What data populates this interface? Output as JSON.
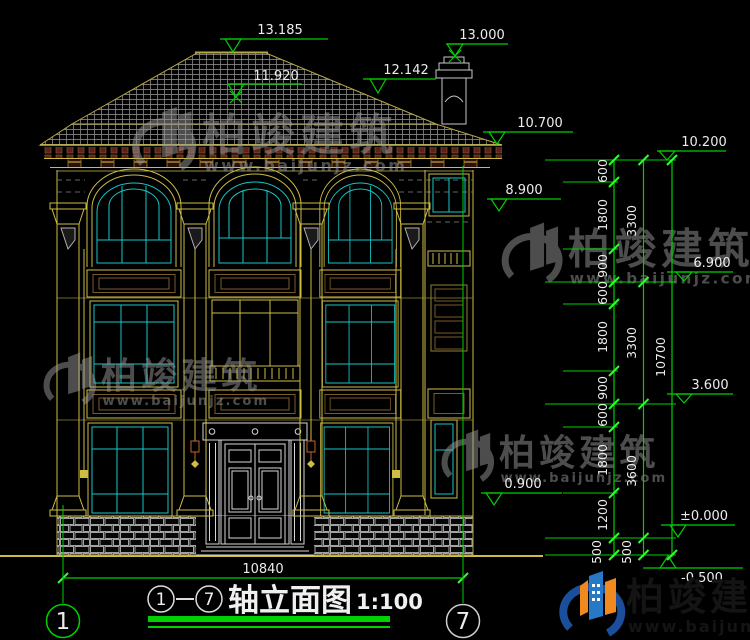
{
  "title": {
    "axis_from": "1",
    "axis_to": "7",
    "name": "轴立面图",
    "scale": "1:100"
  },
  "axis": {
    "left": "1",
    "right": "7"
  },
  "overall_width": "10840",
  "elevations": {
    "ridge": "13.185",
    "chimney": "13.000",
    "roof_step": "12.142",
    "roof_mid": "11.920",
    "eave": "10.700",
    "parapet_top": "10.200",
    "arch_level": "8.900",
    "level_3f": "6.900",
    "level_2f": "3.600",
    "sill_1f": "0.900",
    "zero": "±0.000",
    "site": "-0.500"
  },
  "dim_chain_inner": [
    "600",
    "1800",
    "900",
    "600",
    "1800",
    "900",
    "600",
    "1800",
    "1200",
    "500"
  ],
  "dim_chain_mid": [
    "3300",
    "3300",
    "3600",
    "500"
  ],
  "dim_chain_outer": [
    "10700"
  ],
  "watermark": {
    "brand": "柏竣建筑",
    "url": "www.baijunjz.com"
  },
  "logo": {
    "brand": "柏竣建筑",
    "url": "www.baijunjz.com"
  },
  "colors": {
    "dim_green": "#00cf00",
    "tick_green": "#2aff2a",
    "line_yellow": "#cdbd45",
    "line_yellow_dim": "#8f8433",
    "window_cyan": "#17c6c6",
    "white_line": "#d6d6d6",
    "panel_brown": "#7a5a28",
    "dentil_red": "#5a2418",
    "logo_blue": "#2878c8",
    "logo_orange": "#f08a1e"
  }
}
